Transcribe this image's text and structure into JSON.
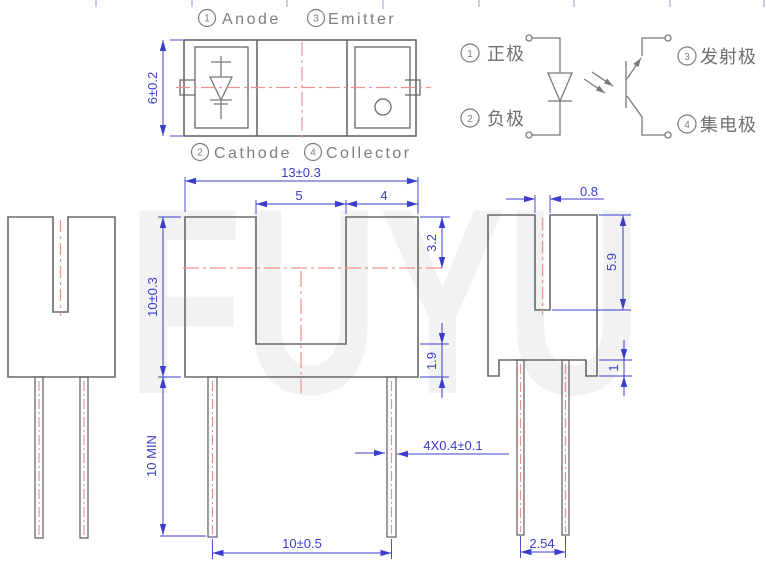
{
  "watermark": "FUYU",
  "colors": {
    "dimension_blue": "#3c3ccd",
    "centerline_red": "#ef9191",
    "outline_gray": "#686868",
    "label_gray": "#7e7e7e",
    "watermark_gray": "#f2f2f2"
  },
  "top_view": {
    "pins": [
      {
        "num": "1",
        "label": "Anode"
      },
      {
        "num": "3",
        "label": "Emitter"
      },
      {
        "num": "2",
        "label": "Cathode"
      },
      {
        "num": "4",
        "label": "Collector"
      }
    ],
    "body_width": "6±0.2"
  },
  "schematic": {
    "pins": [
      {
        "num": "1",
        "label": "正极"
      },
      {
        "num": "2",
        "label": "负极"
      },
      {
        "num": "3",
        "label": "发射极"
      },
      {
        "num": "4",
        "label": "集电极"
      }
    ]
  },
  "front_view": {
    "overall_width": "13±0.3",
    "slot_width": "5",
    "tower_width": "4",
    "optical_axis_depth": "3.2",
    "body_height": "10±0.3",
    "slot_floor_thickness": "1.9",
    "lead_length": "10 MIN",
    "lead_span": "10±0.5",
    "lead_size": "4X0.4±0.1"
  },
  "side_view": {
    "slit_width": "0.8",
    "slit_depth": "5.9",
    "foot_height": "1",
    "lead_pitch": "2.54"
  }
}
